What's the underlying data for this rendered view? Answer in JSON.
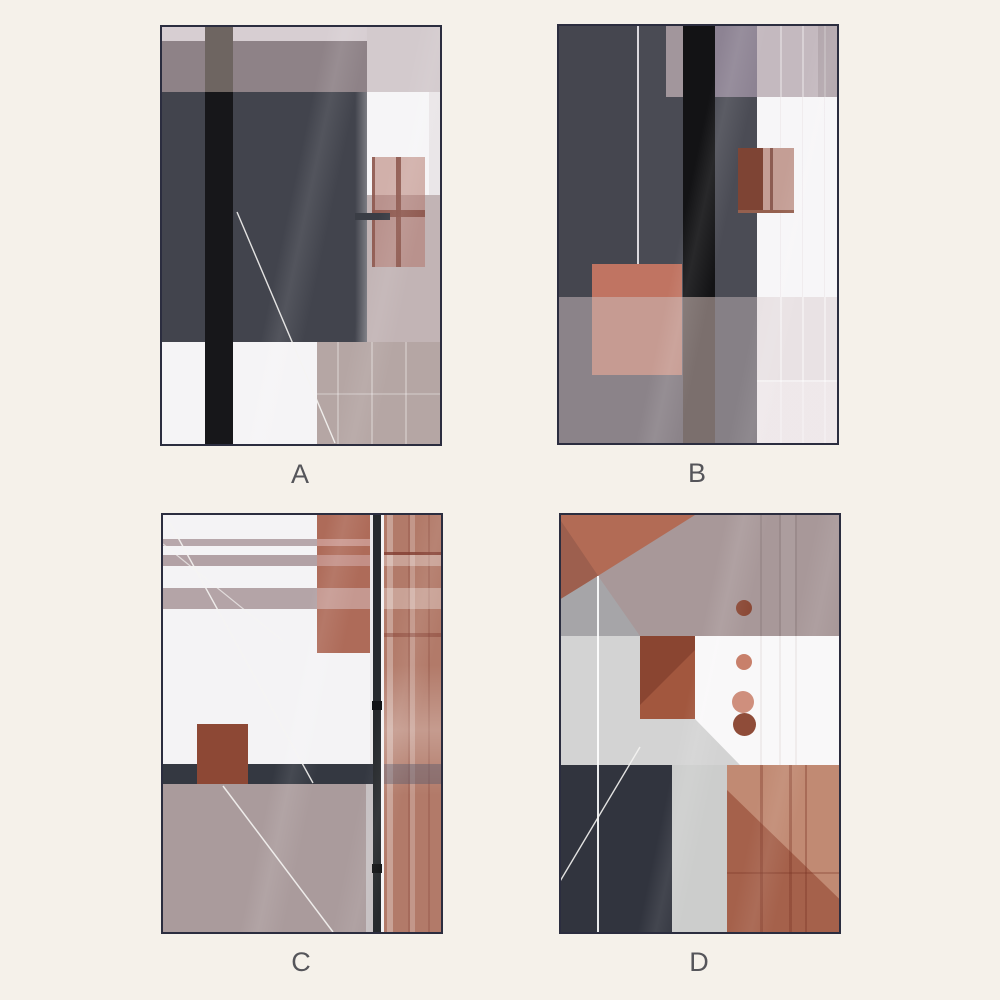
{
  "page": {
    "background_color": "#f5f1ea"
  },
  "gallery": {
    "frame_color": "#2b2d3f",
    "label_color": "#55555a",
    "items": [
      {
        "label": "A"
      },
      {
        "label": "B"
      },
      {
        "label": "C"
      },
      {
        "label": "D"
      }
    ],
    "palette": {
      "terracotta": "#b26b55",
      "rust_brown": "#8a4531",
      "charcoal": "#45464f",
      "black_stripe": "#17171a",
      "navy": "#31343e",
      "mauve": "#a89899",
      "taupe": "#aa9b9c",
      "light_gray": "#d3d3d3",
      "white": "#f7f6f8",
      "cream": "#f5f1ea"
    }
  }
}
